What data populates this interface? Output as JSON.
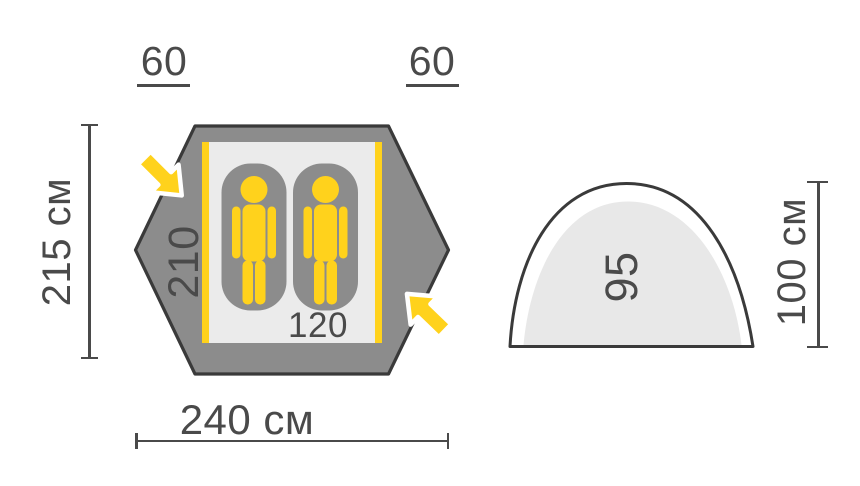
{
  "diagram": {
    "type": "tent-dimensions-diagram",
    "views": [
      "top-view",
      "side-view"
    ]
  },
  "labels": {
    "vestibule_left": "60",
    "vestibule_right": "60",
    "outer_height": "215 см",
    "outer_width": "240 см",
    "inner_length": "210",
    "inner_width": "120",
    "side_inner_height": "95",
    "side_outer_height": "100 см"
  },
  "icons": {
    "entrance_arrows": [
      "entrance-arrow-icon",
      "entrance-arrow-icon"
    ],
    "sleepers": [
      "sleeping-bag-icon with person-icon",
      "sleeping-bag-icon with person-icon"
    ]
  },
  "colors": {
    "tent_fabric_gray": "#8C8C8C",
    "outline_dark": "#3A3A3A",
    "floor_light": "#EBEBEB",
    "accent_yellow": "#FFD21C",
    "side_inner_fill": "#E8E8E8",
    "dimension_text": "#4A4A4A",
    "background": "#FFFFFF"
  }
}
